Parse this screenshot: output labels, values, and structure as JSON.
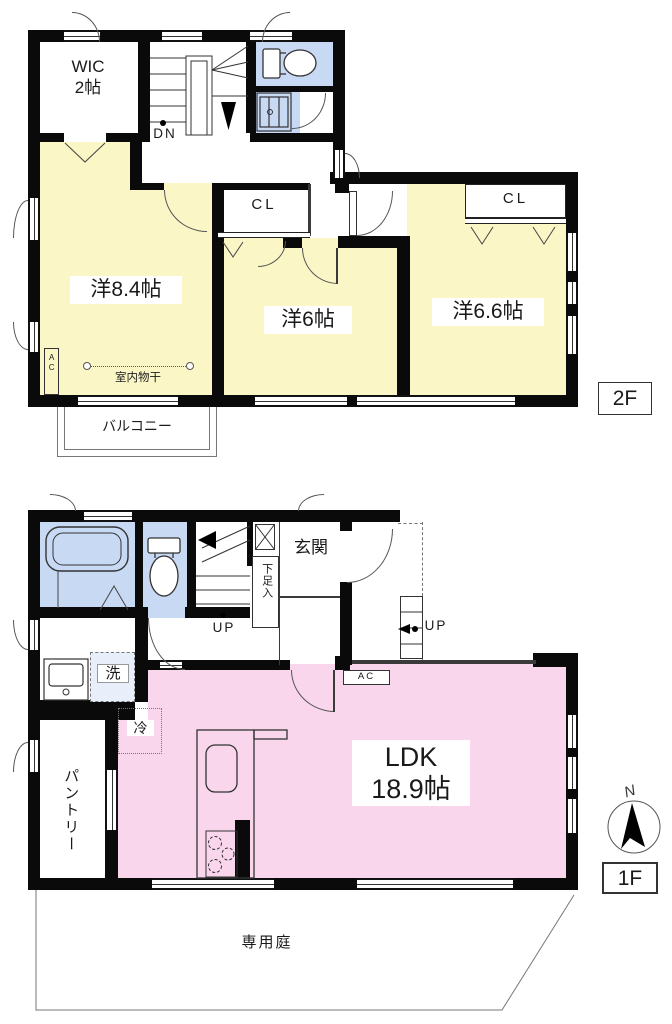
{
  "colors": {
    "room_yellow": "#FAF6C6",
    "water_blue": "#C8D9F3",
    "ldk_pink": "#F9D6EC",
    "wall": "#0A0A0A"
  },
  "floor2": {
    "floor_label": "2F",
    "wic_line1": "WIC",
    "wic_line2": "2帖",
    "stairs_down": "DN",
    "closet_mid": "CL",
    "closet_right": "CL",
    "room_84": "洋8.4帖",
    "room_6": "洋6帖",
    "room_66": "洋6.6帖",
    "ac_unit": "AC",
    "indoor_drying": "室内物干",
    "balcony": "バルコニー"
  },
  "floor1": {
    "floor_label": "1F",
    "entrance": "玄関",
    "shoe_cabinet": "下足入",
    "stairs_up": "UP",
    "porch_up": "UP",
    "laundry": "洗",
    "pantry": "パントリー",
    "fridge": "冷",
    "ac_unit": "AC",
    "ldk_line1": "LDK",
    "ldk_line2": "18.9帖",
    "garden": "専用庭",
    "compass_north": "N"
  }
}
